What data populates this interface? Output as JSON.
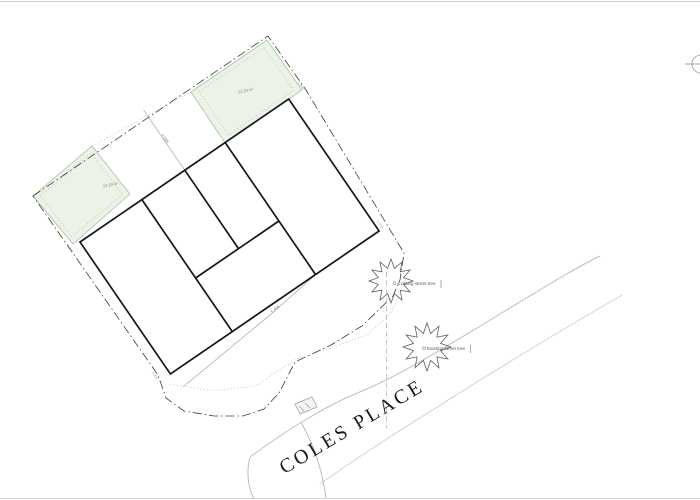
{
  "plan": {
    "street_label": "COLES PLACE",
    "green_areas": [
      {
        "name": "rear-amenity-left",
        "area_label": "24.29 m²"
      },
      {
        "name": "rear-amenity-right",
        "area_label": "24.29 m²"
      }
    ],
    "trees": [
      {
        "label": "Existing street tree"
      },
      {
        "label": "Existing street tree"
      }
    ],
    "dimensions": {
      "rear_garden": "4.588",
      "front_line": "5.486",
      "ticks": [
        "1.000",
        "1.000",
        "1.000",
        "1.000"
      ]
    },
    "colors": {
      "green_fill": "#eaf3e6",
      "green_stroke": "#a9c29f",
      "building_line": "#161616",
      "boundary_line": "#3c3c3c",
      "thin_line": "#9a9a9a",
      "road_line": "#bdbdbd",
      "label_gray": "#8a8a8a"
    }
  }
}
